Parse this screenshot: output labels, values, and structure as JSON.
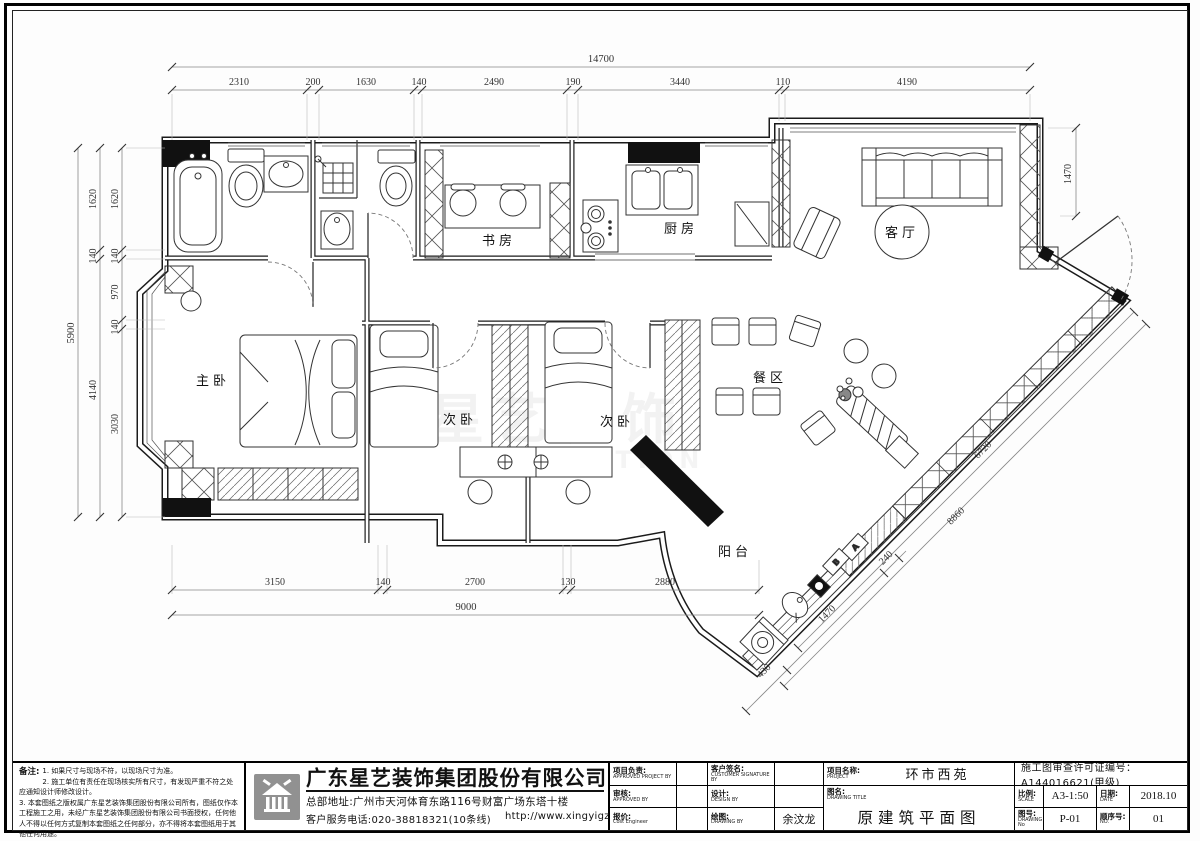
{
  "watermark": {
    "line1": "星艺装饰",
    "line2": "DECORATION"
  },
  "rooms": {
    "master": "主卧",
    "bedroom2": "次卧",
    "bedroom3": "次卧",
    "study": "书房",
    "kitchen": "厨房",
    "living": "客厅",
    "dining": "餐区",
    "balcony": "阳台"
  },
  "markers": {
    "a": "A",
    "b": "B"
  },
  "dims": {
    "top_total": "14700",
    "top": [
      "2310",
      "200",
      "1630",
      "140",
      "2490",
      "190",
      "3440",
      "110",
      "4190"
    ],
    "left_total": "5900",
    "left_outer": [
      "1620",
      "140",
      "4140"
    ],
    "left_inner": [
      "1620",
      "140",
      "970",
      "140",
      "3030"
    ],
    "bottom": [
      "3150",
      "140",
      "2700",
      "130",
      "2880"
    ],
    "bottom_total": "9000",
    "right_v": "1470",
    "diag_inner": "6720",
    "diag_outer": "8860",
    "balcony": [
      "430",
      "1470",
      "240"
    ]
  },
  "notes": {
    "heading": "备注:",
    "line1": "1. 如果尺寸与现场不符，以现场尺寸为准。",
    "line2": "2. 施工单位有责任在现场核实所有尺寸，有发现严重不符之处应通知设计师修改设计。",
    "line3": "3. 本套图纸之版权属广东星艺装饰集团股份有限公司所有，图纸仅作本工程施工之用，未经广东星艺装饰集团股份有限公司书面授权，任何他人不得以任何方式复制本套图纸之任何部分，亦不得将本套图纸用于其他任何用途。"
  },
  "company": {
    "name": "广东星艺装饰集团股份有限公司",
    "address": "总部地址:广州市天河体育东路116号财富广场东塔十楼",
    "phone": "客户服务电话:020-38818321(10条线)",
    "website": "http://www.xingyigz.com.cn"
  },
  "titleblock": {
    "project_lead_cn": "项目负责:",
    "project_lead_en": "APPROVED PROJECT BY",
    "customer_cn": "客户签名:",
    "customer_en": "CUSTOMER SIGNATURE BY",
    "project_cn": "项目名称:",
    "project_en": "PROJECT",
    "project_value": "环市西苑",
    "permit": "施工图审查许可证编号：A144016621(甲级)",
    "review_cn": "审核:",
    "review_en": "APPROVED BY",
    "design_cn": "设计:",
    "design_en": "DESIGN BY",
    "title_cn": "图名:",
    "title_en": "DRAWING TITLE",
    "title_value": "原建筑平面图",
    "scale_cn": "比例:",
    "scale_en": "SCALE",
    "scale_value": "A3-1:50",
    "date_cn": "日期:",
    "date_en": "DATE",
    "date_value": "2018.10",
    "quote_cn": "报价:",
    "quote_en": "Cost Engineer",
    "draw_cn": "绘图:",
    "draw_en": "DRAWING BY",
    "draw_value": "余汶龙",
    "no_cn": "图号:",
    "no_en": "DRAWING No",
    "no_value": "P-01",
    "seq_cn": "顺序号:",
    "seq_en": "NO.",
    "seq_value": "01"
  }
}
